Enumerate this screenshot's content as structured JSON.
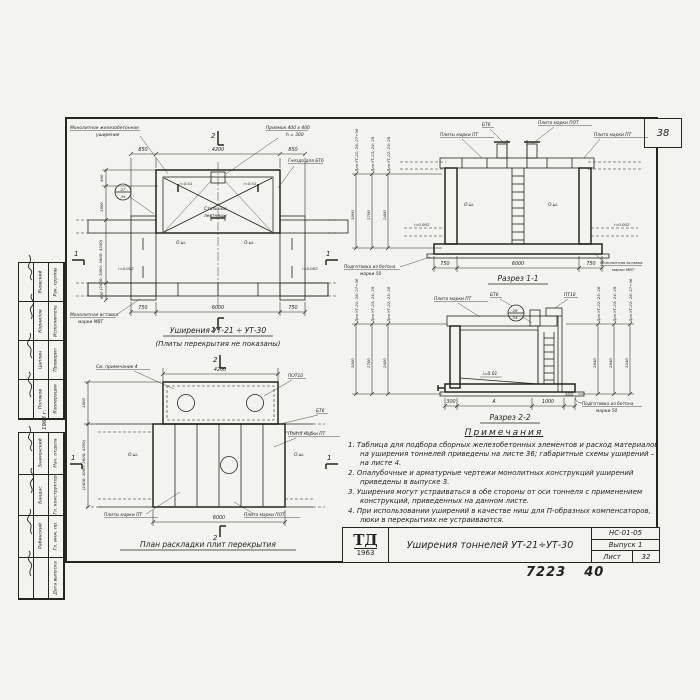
{
  "sheet": {
    "corner_number": "38",
    "stamp_left": "7223",
    "stamp_right": "40"
  },
  "markers": {
    "sec1": "1",
    "sec2": "2"
  },
  "plan_top": {
    "title": "Уширения  УТ-21 ÷ УТ-30",
    "subtitle": "(Плиты перекрытия не показаны)",
    "label_monolithic1": "Монолитное  железобетонное",
    "label_monolithic2": "уширение",
    "label_pit1": "Приямок  400 х 400",
    "label_pit2": "h = 300",
    "label_socket": "Гнездо  для  БТ6",
    "label_insert1": "Монолитная  вставка",
    "label_insert2": "марки  МВТ",
    "label_ladders1": "Стальные",
    "label_ladders2": "лестницы",
    "slope_pit_l": "i=0.01",
    "slope_pit_r": "i=0.01",
    "slope_l": "i=0.002",
    "slope_r": "i=0.002",
    "axis": "О.ш.",
    "bubble_top": "27",
    "bubble_bottom": "34",
    "dims_top": [
      "850",
      "4200",
      "850"
    ],
    "dims_bottom": [
      "750",
      "6000",
      "750"
    ],
    "dims_left": [
      "400",
      "1800",
      "(2400; 3000; 3600; 4200)",
      "600"
    ]
  },
  "section1": {
    "title": "Разрез 1-1",
    "label_btb": "БТ6",
    "label_pot": "Плита марки ПОТ",
    "label_pt_l": "Плиты  марки  ПТ",
    "label_pt_r": "Плита  марки  ПТ",
    "label_prep1": "Подготовка  из  бетона",
    "label_prep2": "марки  50",
    "label_insert1": "Монолитная  вставка",
    "label_insert2": "марки  МВТ",
    "axis": "О.ш.",
    "slope_l": "i=0.002",
    "slope_r": "i=0.002",
    "cols": [
      {
        "for": "Для УТ-21; 26; 27÷30",
        "h": "3000"
      },
      {
        "for": "Для УТ-23; 24; 29",
        "h": "2700"
      },
      {
        "for": "Для УТ-22; 25; 28",
        "h": "2400"
      }
    ],
    "dims_bottom": [
      "750",
      "6000",
      "750"
    ]
  },
  "section2": {
    "title": "Разрез 2-2",
    "label_pt": "Плита  марки  ПТ",
    "label_btb": "БТ6",
    "label_pt10": "ПТ10",
    "bubble_top": "28",
    "bubble_bottom": "34",
    "slope": "i=0.01",
    "label_prep1": "Подготовка  из  бетона",
    "label_prep2": "марки  50",
    "cols_left": [
      {
        "for": "Для УТ-21; 26; 27÷30",
        "h": "3000"
      },
      {
        "for": "Для УТ-23; 24; 29",
        "h": "2700"
      },
      {
        "for": "Для УТ-22; 25; 28",
        "h": "2400"
      }
    ],
    "cols_right": [
      {
        "for": "Для УТ-22; 25; 28",
        "h": "2640"
      },
      {
        "for": "Для УТ-23; 24; 29",
        "h": "2940"
      },
      {
        "for": "Для УТ-21; 26; 27÷30",
        "h": "3240"
      }
    ],
    "dims_bottom": [
      "300",
      "А",
      "1000",
      "300"
    ]
  },
  "plan_bottom": {
    "title": "План  раскладки  плит  перекрытия",
    "label_note": "См. примечание 4",
    "label_pot10": "ПОТ10",
    "label_btb": "БТ6",
    "label_pt_r": "Плита  марки  ПТ",
    "label_pt_l": "Плиты  марки  ПТ",
    "label_pot": "Плита  марки  ПОТ",
    "axis": "О.ш.",
    "dim_top": "4200",
    "dim_bottom": "6000",
    "dims_left": [
      "1800",
      "(2400; 3000; 3600; 4200)"
    ]
  },
  "notes": {
    "title": "Примечания",
    "items": [
      "1. Таблица для подбора сборных железобетонных элементов и расход материалов на уширения тоннелей приведены на листе 36; габаритные схемы уширений – на листе 4.",
      "2. Опалубочные и арматурные чертежи монолитных конструкций уширений приведены в выпуске 3.",
      "3. Уширения могут устраиваться в обе стороны от оси тоннеля с применением конструкций, приведенных на данном листе.",
      "4. При использовании уширений в качестве ниш для П-образных компенсаторов, люки в перекрытиях не устраиваются."
    ]
  },
  "title_block": {
    "logo_abbr": "ТД",
    "logo_year": "1963",
    "title": "Уширения  тоннелей  УТ-21÷УТ-30",
    "code": "НС-01-05",
    "issue": "Выпуск 1",
    "sheet_label": "Лист",
    "sheet_value": "32"
  },
  "margin": {
    "year": "1963 г.",
    "group1_roles": [
      "Рук. группы",
      "Исполнитель",
      "Проверил",
      "Кооперация"
    ],
    "group1_names": [
      "Яновский",
      "Корнилов",
      "Цаплин",
      "Поляков"
    ],
    "group2_roles": [
      "Нач. отдела",
      "Гл. конструктор",
      "Гл. инж. пр.",
      "Дата выпуска"
    ],
    "group2_names": [
      "Знаменский",
      "Бандас",
      "Рабинский",
      ""
    ]
  }
}
